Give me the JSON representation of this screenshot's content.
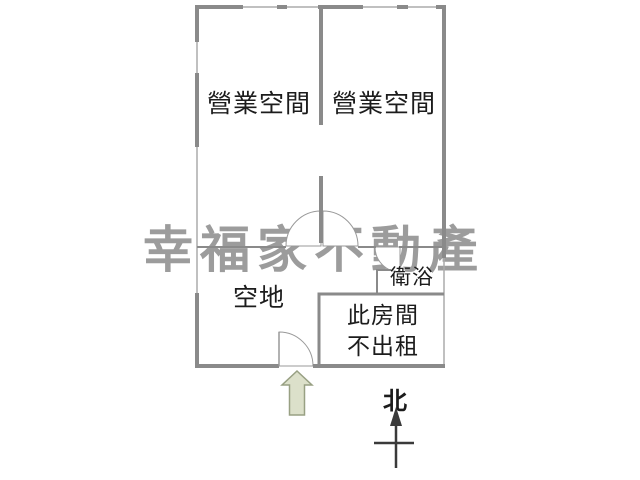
{
  "floorplan": {
    "watermark": "幸福家不動產",
    "rooms": {
      "business_left": "營業空間",
      "business_right": "營業空間",
      "open_space": "空地",
      "bathroom": "衛浴",
      "not_rented_line1": "此房間",
      "not_rented_line2": "不出租"
    },
    "compass": {
      "north_label": "北"
    },
    "colors": {
      "wall": "#8a8a8a",
      "window_line": "#ababab",
      "door_arc": "#999999",
      "watermark": "#9c9c9c",
      "text": "#1c1c1c",
      "entrance_arrow_fill": "#dce0ca",
      "entrance_arrow_stroke": "#98a083",
      "north_arrow": "#3a3a3a"
    }
  }
}
